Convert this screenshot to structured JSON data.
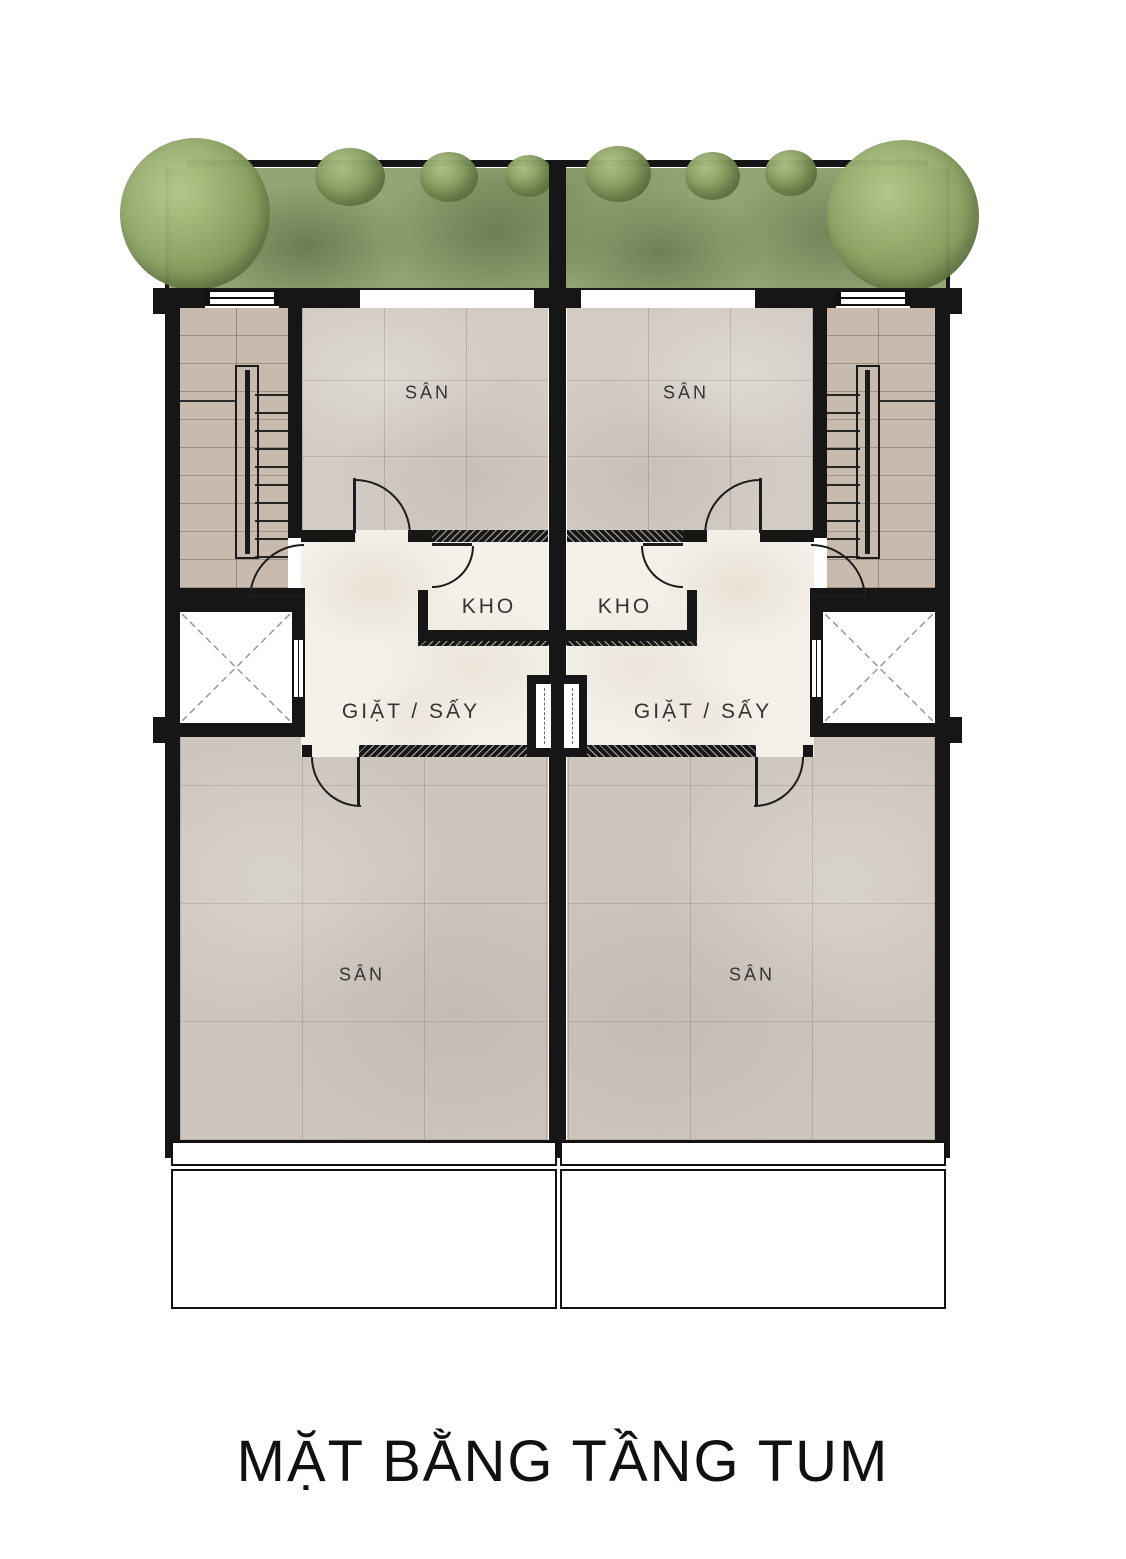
{
  "title": "MẶT BẰNG TẦNG TUM",
  "rooms": [
    {
      "id": "san-top-left",
      "label": "SÂN"
    },
    {
      "id": "san-top-right",
      "label": "SÂN"
    },
    {
      "id": "kho-left",
      "label": "KHO"
    },
    {
      "id": "kho-right",
      "label": "KHO"
    },
    {
      "id": "laundry-left",
      "label": "GIẶT / SẤY"
    },
    {
      "id": "laundry-right",
      "label": "GIẶT / SẤY"
    },
    {
      "id": "san-bottom-left",
      "label": "SÂN"
    },
    {
      "id": "san-bottom-right",
      "label": "SÂN"
    }
  ],
  "icons": {
    "door": "door-swing-arc",
    "elevator": "elevator-x-shaft",
    "stairs": "stair-treads",
    "tree": "tree-canopy",
    "window": "window-double-line"
  },
  "colors": {
    "wall": "#161616",
    "line": "#1c1c1c",
    "green": "#93a475",
    "tile_top": "#d3ccc5",
    "tile_bottom": "#cdc6be",
    "wood": "#c8bbae",
    "cream": "#f4f1ea",
    "paper": "#ffffff",
    "label": "#343434"
  }
}
